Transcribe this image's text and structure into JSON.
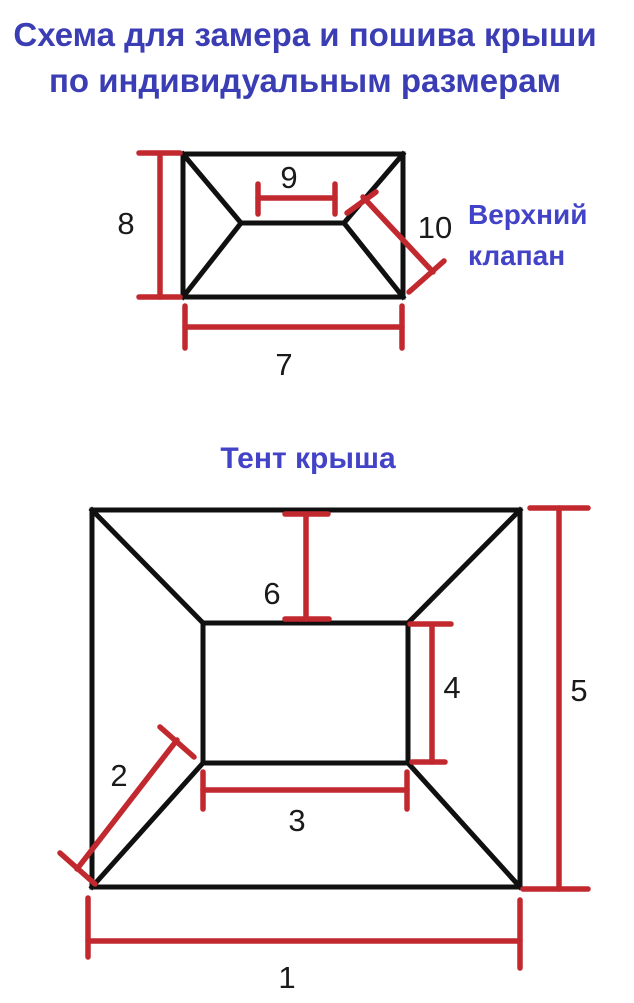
{
  "title": {
    "line1": "Схема для замера и пошива крыши",
    "line2": "по индивидуальным размерам"
  },
  "colors": {
    "title_blue": "#3b3db4",
    "label_blue": "#4343c8",
    "dimension_red": "#c2292f",
    "outline_black": "#101010"
  },
  "top_diagram": {
    "label_line1": "Верхний",
    "label_line2": "клапан",
    "dims": {
      "height": "8",
      "ridge": "9",
      "hip": "10",
      "width": "7"
    }
  },
  "bottom_diagram": {
    "heading": "Тент крыша",
    "dims": {
      "top_slope": "6",
      "inner_height": "4",
      "outer_height": "5",
      "hip": "2",
      "inner_width": "3",
      "outer_width": "1"
    }
  }
}
